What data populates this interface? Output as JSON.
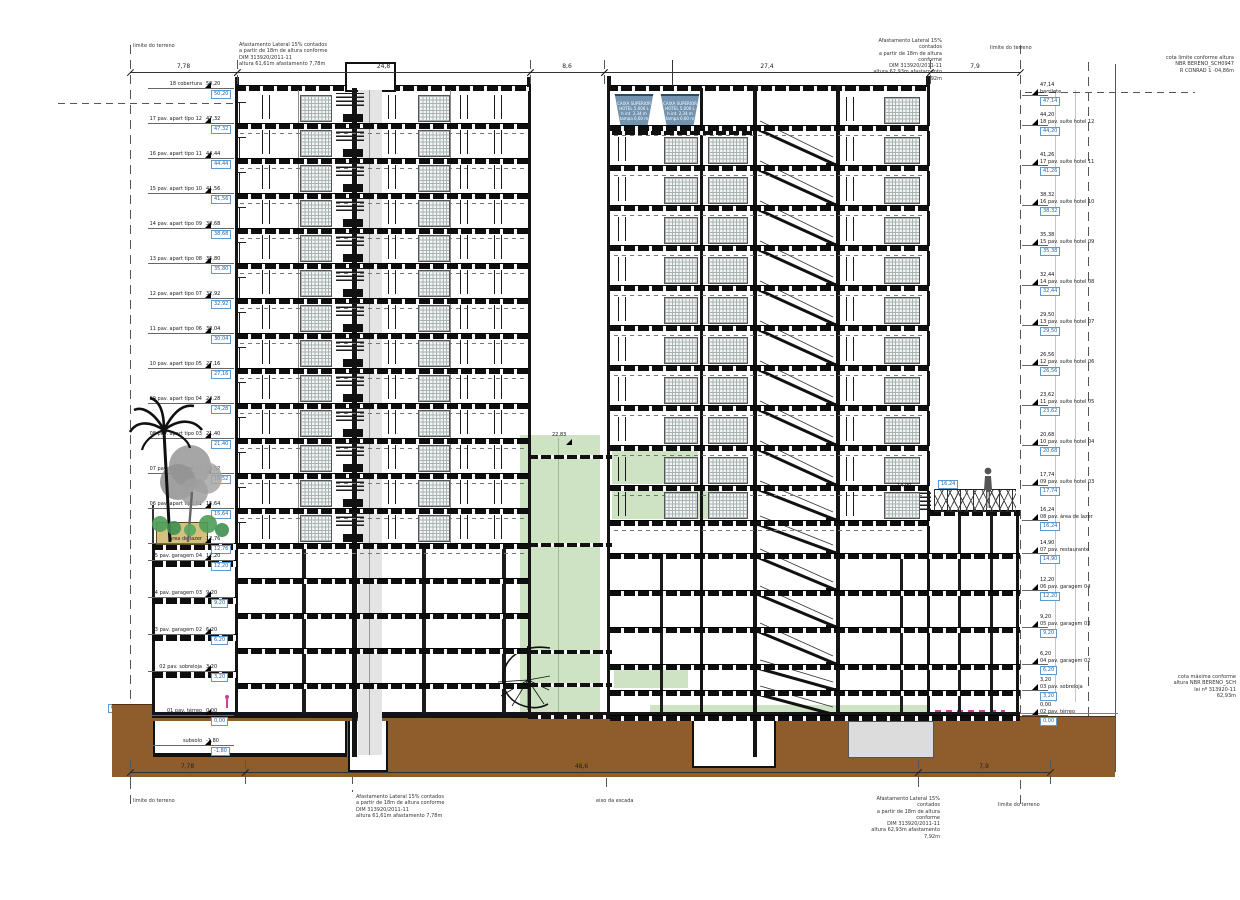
{
  "colors": {
    "highlight_green": "#cde3c3",
    "earth_brown": "#8f5c2b",
    "tank_blue": "#7394b0",
    "marker_blue": "#2565ae",
    "sidewalk_teal": "#2aa8a0",
    "accent_magenta": "#cc3fa0"
  },
  "annotations": {
    "limite_terreno": "limite do terreno",
    "setback_left": [
      "Afastamento Lateral 15%  contados",
      "a partir de 18m de altura conforme",
      "DIM 313920/2011-11",
      "altura 61,61m afastamento 7,78m"
    ],
    "setback_right": [
      "Afastamento Lateral 15%  contados",
      "a partir de 18m de altura conforme",
      "DIM 313920/2011-11",
      "altura 62,93m afastamento 7,92m"
    ],
    "far_right_note": [
      "cota limite conforme altura",
      "NBR BERENO_SCH0947",
      "R CONRAD 1 -04,86m"
    ],
    "mid_right_note": [
      "cota máxima conforme",
      "altura NBR BERENO_SCH",
      "lei nº 313920-11",
      "62,93m"
    ],
    "eixo_label": "eixo da escada",
    "shaft_elev": "22,83",
    "terrace_elev": "16,24",
    "terrace_elev2": "14,90",
    "street_elev": "0,00"
  },
  "dimensions": {
    "top": [
      "7,78",
      "24,8",
      "8,6",
      "27,4",
      "7,9"
    ],
    "bottom": [
      "7,78",
      "48,6",
      "7,9"
    ]
  },
  "water_tank": [
    "CAIXA SUPERIOR",
    "HOTEL 5.000 L",
    "h int. 2,34 m",
    "tampa 0,60 m"
  ],
  "levels": {
    "left": [
      {
        "label": "18 cobertura",
        "elev": "50,20"
      },
      {
        "label": "17 pav. apart tipo 12",
        "elev": "47,32"
      },
      {
        "label": "16 pav. apart tipo 11",
        "elev": "44,44"
      },
      {
        "label": "15 pav. apart tipo 10",
        "elev": "41,56"
      },
      {
        "label": "14 pav. apart tipo 09",
        "elev": "38,68"
      },
      {
        "label": "13 pav. apart tipo 08",
        "elev": "35,80"
      },
      {
        "label": "12 pav. apart tipo 07",
        "elev": "32,92"
      },
      {
        "label": "11 pav. apart tipo 06",
        "elev": "30,04"
      },
      {
        "label": "10 pav. apart tipo 05",
        "elev": "27,16"
      },
      {
        "label": "09 pav. apart tipo 04",
        "elev": "24,28"
      },
      {
        "label": "08 pav. apart tipo 03",
        "elev": "21,40"
      },
      {
        "label": "07 pav. apart tipo 02",
        "elev": "18,52"
      },
      {
        "label": "06 pav. apart tipo 01",
        "elev": "15,64"
      },
      {
        "label": "área de lazer",
        "elev": "12,76"
      },
      {
        "label": "05 pav. garagem 04",
        "elev": "12,20"
      },
      {
        "label": "04 pav. garagem 03",
        "elev": "9,20"
      },
      {
        "label": "03 pav. garagem 02",
        "elev": "6,20"
      },
      {
        "label": "02 pav. sobreloja",
        "elev": "3,20"
      },
      {
        "label": "01 pav. térreo",
        "elev": "0,00"
      },
      {
        "label": "subsolo",
        "elev": "-1,80"
      }
    ],
    "right": [
      {
        "label": "barrilete",
        "elev": "47,14"
      },
      {
        "label": "18 pav. suíte hotel 12",
        "elev": "44,20"
      },
      {
        "label": "17 pav. suíte hotel 11",
        "elev": "41,26"
      },
      {
        "label": "16 pav. suíte hotel 10",
        "elev": "38,32"
      },
      {
        "label": "15 pav. suíte hotel 09",
        "elev": "35,38"
      },
      {
        "label": "14 pav. suíte hotel 08",
        "elev": "32,44"
      },
      {
        "label": "13 pav. suíte hotel 07",
        "elev": "29,50"
      },
      {
        "label": "12 pav. suíte hotel 06",
        "elev": "26,56"
      },
      {
        "label": "11 pav. suíte hotel 05",
        "elev": "23,62"
      },
      {
        "label": "10 pav. suíte hotel 04",
        "elev": "20,68"
      },
      {
        "label": "09 pav. suíte hotel 03",
        "elev": "17,74"
      },
      {
        "label": "08 pav. área de lazer",
        "elev": "16,24"
      },
      {
        "label": "07 pav. restaurante",
        "elev": "14,90"
      },
      {
        "label": "06 pav. garagem 04",
        "elev": "12,20"
      },
      {
        "label": "05 pav. garagem 03",
        "elev": "9,20"
      },
      {
        "label": "04 pav. garagem 02",
        "elev": "6,20"
      },
      {
        "label": "03 pav. sobreloja",
        "elev": "3,20"
      },
      {
        "label": "02 pav. térreo",
        "elev": "0,00"
      }
    ]
  }
}
